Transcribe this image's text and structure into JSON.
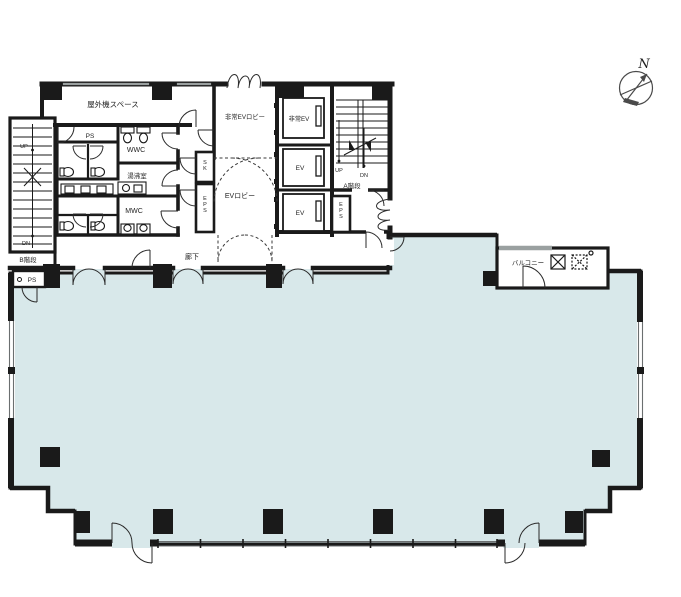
{
  "plan": {
    "colors": {
      "office_fill": "#d8e8ea",
      "wall": "#1a1a1a",
      "window_gray": "#9aa0a0"
    },
    "labels": {
      "outdoor_unit_space": "屋外機スペース",
      "ps_upper": "PS",
      "wwc": "WWC",
      "kitchenette": "湯沸室",
      "mwc": "MWC",
      "corridor": "廊下",
      "emergency_ev_lobby": "非常EVロビー",
      "emergency_ev": "非常EV",
      "ev_1": "EV",
      "ev_2": "EV",
      "ev_lobby": "EVロビー",
      "sk": "SK",
      "eps_left": "EPS",
      "eps_right": "EPS",
      "ps_lower": "PS",
      "balcony": "バルコニー"
    },
    "stair_b": {
      "name": "B階段",
      "up": "UP",
      "dn": "DN"
    },
    "stair_a": {
      "name": "A階段",
      "up": "UP",
      "dn": "DN"
    },
    "compass": {
      "north": "N"
    }
  }
}
